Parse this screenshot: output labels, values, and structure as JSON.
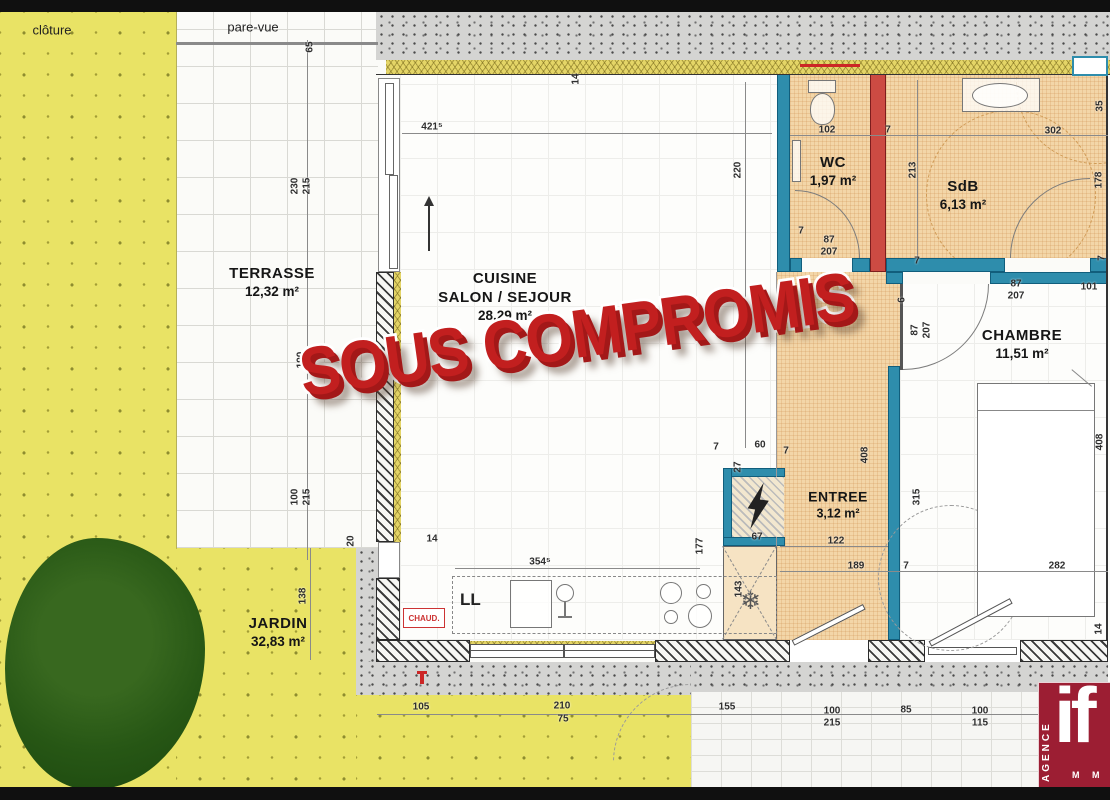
{
  "stamp": {
    "text": "SOUS COMPROMIS"
  },
  "site": {
    "cloture": "clôture",
    "pare_vue": "pare-vue"
  },
  "rooms": {
    "terrasse": {
      "name": "TERRASSE",
      "area": "12,32 m²"
    },
    "cuisine": {
      "name": "CUISINE",
      "name2": "SALON / SEJOUR",
      "area": "28,29 m²"
    },
    "wc": {
      "name": "WC",
      "area": "1,97 m²"
    },
    "sdb": {
      "name": "SdB",
      "area": "6,13 m²"
    },
    "chambre": {
      "name": "CHAMBRE",
      "area": "11,51 m²"
    },
    "entree": {
      "name": "ENTREE",
      "area": "3,12 m²"
    },
    "jardin": {
      "name": "JARDIN",
      "area": "32,83 m²"
    }
  },
  "appliances": {
    "washer": "LL",
    "boiler": "CHAUD.",
    "fridge_icon": "❄"
  },
  "logo": {
    "agence": "AGENCE",
    "brand": "if",
    "sub": "M M"
  },
  "colors": {
    "stamp_red": "#c21f1f",
    "wall_teal": "#2e8dac",
    "wall_red": "#cc4b43",
    "garden_yellow": "#e9e365",
    "floor_tan": "#f3d6a8",
    "logo_maroon": "#9c1e33"
  },
  "dimensions": [
    {
      "t": "65",
      "x": 310,
      "y": 47,
      "v": 1
    },
    {
      "t": "421⁵",
      "x": 432,
      "y": 127
    },
    {
      "t": "14",
      "x": 576,
      "y": 79,
      "v": 1
    },
    {
      "t": "220",
      "x": 738,
      "y": 170,
      "v": 1
    },
    {
      "t": "230",
      "x": 295,
      "y": 186,
      "v": 1
    },
    {
      "t": "215",
      "x": 307,
      "y": 186,
      "v": 1
    },
    {
      "t": "190",
      "x": 301,
      "y": 360,
      "v": 1
    },
    {
      "t": "100",
      "x": 295,
      "y": 497,
      "v": 1
    },
    {
      "t": "215",
      "x": 307,
      "y": 497,
      "v": 1
    },
    {
      "t": "20",
      "x": 351,
      "y": 541,
      "v": 1
    },
    {
      "t": "14",
      "x": 432,
      "y": 539
    },
    {
      "t": "102",
      "x": 827,
      "y": 130
    },
    {
      "t": "7",
      "x": 888,
      "y": 130
    },
    {
      "t": "302",
      "x": 1053,
      "y": 131
    },
    {
      "t": "213",
      "x": 913,
      "y": 170,
      "v": 1
    },
    {
      "t": "35",
      "x": 1100,
      "y": 106,
      "v": 1
    },
    {
      "t": "178",
      "x": 1099,
      "y": 180,
      "v": 1
    },
    {
      "t": "7",
      "x": 801,
      "y": 231
    },
    {
      "t": "87",
      "x": 829,
      "y": 240
    },
    {
      "t": "207",
      "x": 829,
      "y": 252
    },
    {
      "t": "7",
      "x": 917,
      "y": 261
    },
    {
      "t": "7",
      "x": 1102,
      "y": 258,
      "v": 1
    },
    {
      "t": "87",
      "x": 1016,
      "y": 284
    },
    {
      "t": "207",
      "x": 1016,
      "y": 296
    },
    {
      "t": "101",
      "x": 1089,
      "y": 287
    },
    {
      "t": "6",
      "x": 902,
      "y": 300,
      "v": 1
    },
    {
      "t": "87",
      "x": 915,
      "y": 330,
      "v": 1
    },
    {
      "t": "207",
      "x": 927,
      "y": 330,
      "v": 1
    },
    {
      "t": "408",
      "x": 1100,
      "y": 442,
      "v": 1
    },
    {
      "t": "408",
      "x": 865,
      "y": 455,
      "v": 1
    },
    {
      "t": "315",
      "x": 917,
      "y": 497,
      "v": 1
    },
    {
      "t": "7",
      "x": 716,
      "y": 447
    },
    {
      "t": "60",
      "x": 760,
      "y": 445
    },
    {
      "t": "7",
      "x": 786,
      "y": 451
    },
    {
      "t": "27",
      "x": 738,
      "y": 467,
      "v": 1
    },
    {
      "t": "67",
      "x": 757,
      "y": 537
    },
    {
      "t": "122",
      "x": 836,
      "y": 541
    },
    {
      "t": "177",
      "x": 700,
      "y": 546,
      "v": 1
    },
    {
      "t": "143",
      "x": 739,
      "y": 589,
      "v": 1
    },
    {
      "t": "189",
      "x": 856,
      "y": 566
    },
    {
      "t": "7",
      "x": 906,
      "y": 566
    },
    {
      "t": "282",
      "x": 1057,
      "y": 566
    },
    {
      "t": "354⁵",
      "x": 540,
      "y": 562
    },
    {
      "t": "14",
      "x": 1099,
      "y": 629,
      "v": 1
    },
    {
      "t": "138",
      "x": 303,
      "y": 596,
      "v": 1
    },
    {
      "t": "105",
      "x": 421,
      "y": 707
    },
    {
      "t": "210",
      "x": 562,
      "y": 706
    },
    {
      "t": "75",
      "x": 563,
      "y": 719
    },
    {
      "t": "155",
      "x": 727,
      "y": 707
    },
    {
      "t": "100",
      "x": 832,
      "y": 711
    },
    {
      "t": "215",
      "x": 832,
      "y": 723
    },
    {
      "t": "85",
      "x": 906,
      "y": 710
    },
    {
      "t": "100",
      "x": 980,
      "y": 711
    },
    {
      "t": "115",
      "x": 980,
      "y": 723
    }
  ]
}
